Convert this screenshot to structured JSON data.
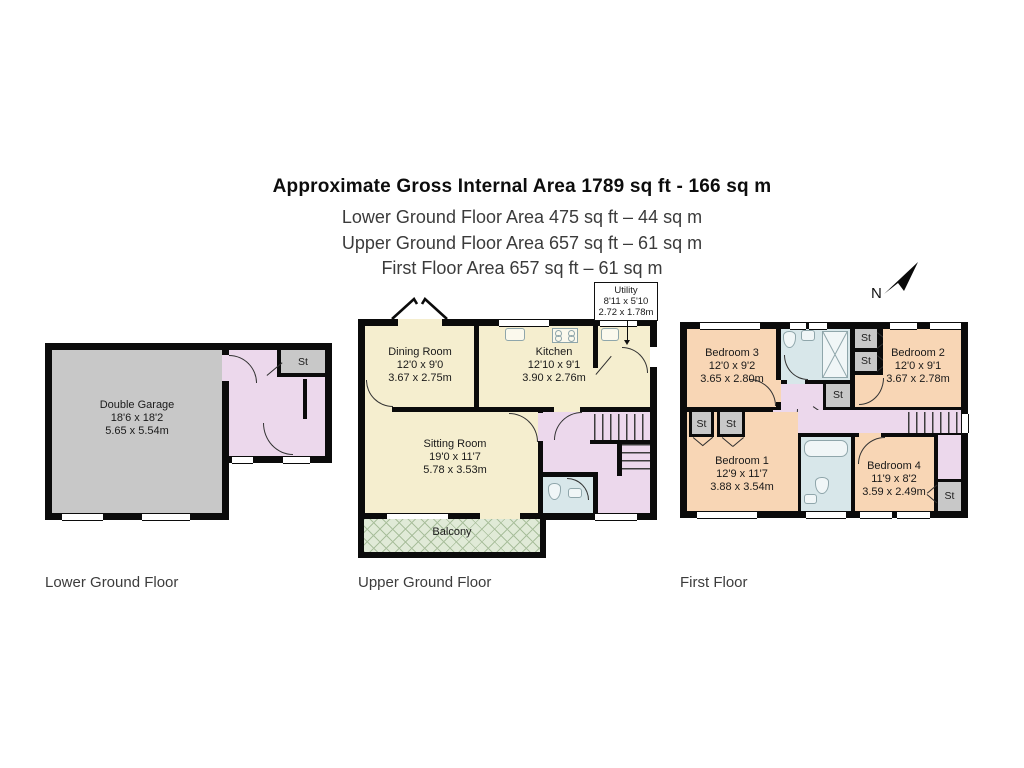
{
  "header": {
    "title": "Approximate Gross Internal Area 1789 sq ft - 166 sq m",
    "lines": [
      "Lower Ground Floor Area 475 sq ft – 44 sq m",
      "Upper Ground Floor Area 657 sq ft – 61 sq m",
      "First Floor Area 657 sq ft – 61 sq m"
    ]
  },
  "compass": {
    "north": "N"
  },
  "labels": {
    "st": "St"
  },
  "floors": {
    "lower": {
      "caption": "Lower Ground Floor",
      "garage": {
        "name": "Double Garage",
        "imperial": "18'6 x 18'2",
        "metric": "5.65 x 5.54m"
      }
    },
    "upper": {
      "caption": "Upper Ground Floor",
      "dining": {
        "name": "Dining Room",
        "imperial": "12'0 x 9'0",
        "metric": "3.67 x 2.75m"
      },
      "kitchen": {
        "name": "Kitchen",
        "imperial": "12'10 x 9'1",
        "metric": "3.90 x 2.76m"
      },
      "utility": {
        "name": "Utility",
        "imperial": "8'11 x 5'10",
        "metric": "2.72 x 1.78m"
      },
      "sitting": {
        "name": "Sitting Room",
        "imperial": "19'0 x 11'7",
        "metric": "5.78 x 3.53m"
      },
      "balcony": {
        "name": "Balcony"
      }
    },
    "first": {
      "caption": "First Floor",
      "bedroom1": {
        "name": "Bedroom 1",
        "imperial": "12'9 x 11'7",
        "metric": "3.88 x 3.54m"
      },
      "bedroom2": {
        "name": "Bedroom 2",
        "imperial": "12'0 x 9'1",
        "metric": "3.67 x 2.78m"
      },
      "bedroom3": {
        "name": "Bedroom 3",
        "imperial": "12'0 x 9'2",
        "metric": "3.65 x 2.80m"
      },
      "bedroom4": {
        "name": "Bedroom 4",
        "imperial": "11'9 x 8'2",
        "metric": "3.59 x 2.49m"
      }
    }
  },
  "colors": {
    "wall": "#0b0b0b",
    "living_cream": "#f5eecf",
    "hall_lilac": "#ecd8ec",
    "bedroom_peach": "#f8d6b5",
    "bathroom_blue": "#d8e7ea",
    "storage_gray": "#c8c8c8",
    "balcony_green": "#e0ead7"
  }
}
